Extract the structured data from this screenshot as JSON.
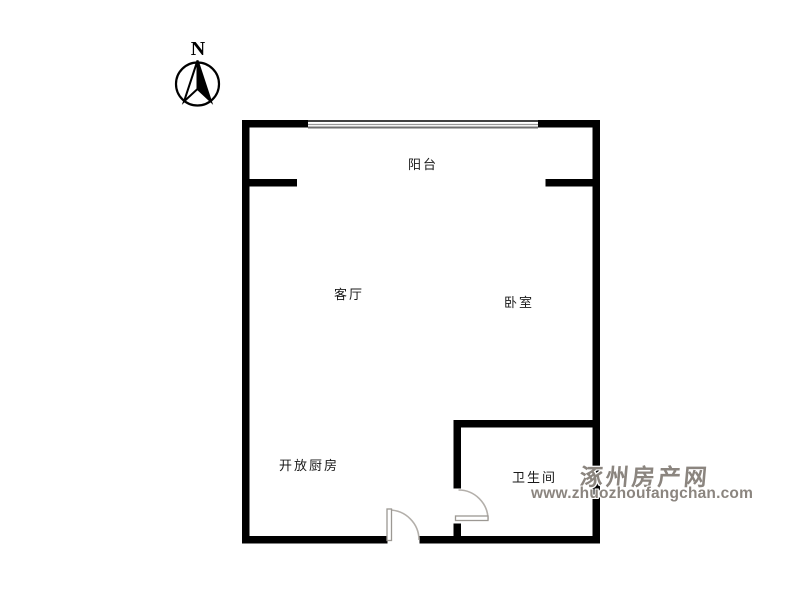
{
  "page": {
    "background": "#ffffff",
    "type_label": "apartment-floor-plan"
  },
  "compass": {
    "label": "N"
  },
  "rooms": {
    "balcony": {
      "label": "阳台"
    },
    "living_room": {
      "label": "客厅"
    },
    "bedroom": {
      "label": "卧室"
    },
    "open_kitchen": {
      "label": "开放厨房"
    },
    "bathroom": {
      "label": "卫生间"
    }
  },
  "watermark": {
    "site_name": "涿州房产网",
    "site_url": "www.zhuozhoufangchan.com",
    "color": "#8b857f"
  },
  "colors": {
    "wall": "#000000",
    "window_line_dark": "#404040",
    "window_line_mid": "#999999",
    "door_arc": "#b3afaa",
    "door_leaf_border": "#9c9893",
    "label_text": "#1a1a1a"
  }
}
